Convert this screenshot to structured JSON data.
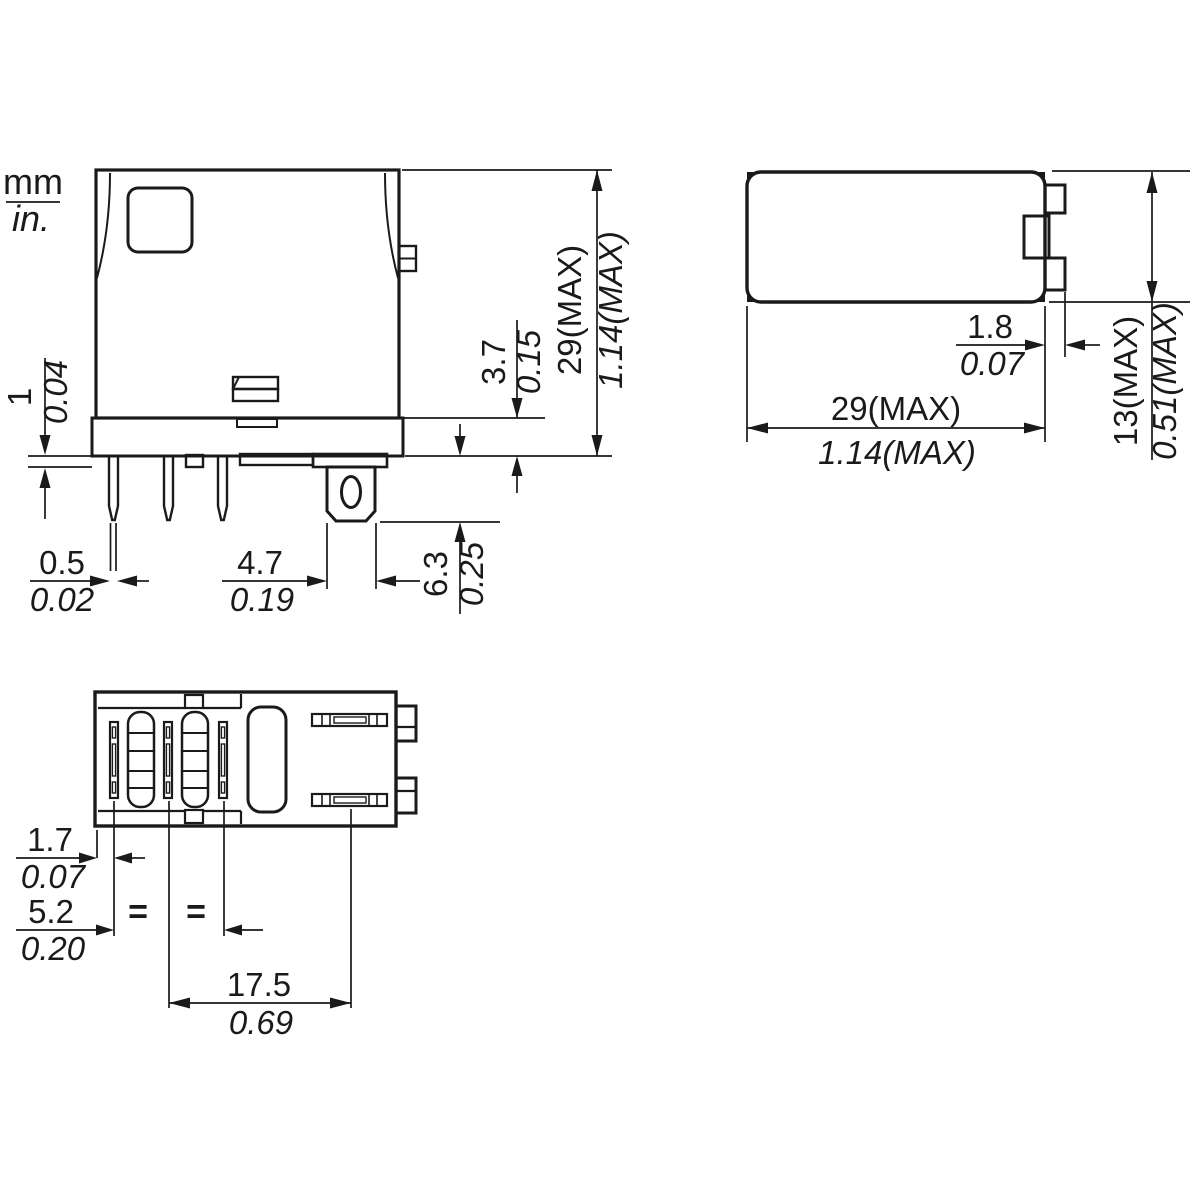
{
  "legend": {
    "mm": "mm",
    "in": "in."
  },
  "colors": {
    "body_fill": "#dcdcdc",
    "line": "#1a1a1a",
    "hole_fill": "#ffffff"
  },
  "views": {
    "front": {
      "dims": {
        "standoff": {
          "mm": "1",
          "in": "0.04"
        },
        "base_height": {
          "mm": "3.7",
          "in": "0.15"
        },
        "height": {
          "mm": "29(MAX)",
          "in": "1.14(MAX)"
        },
        "pin_width": {
          "mm": "0.5",
          "in": "0.02"
        },
        "tab_width": {
          "mm": "4.7",
          "in": "0.19"
        },
        "tab_length": {
          "mm": "6.3",
          "in": "0.25"
        }
      }
    },
    "top": {
      "dims": {
        "tab_protrusion": {
          "mm": "1.8",
          "in": "0.07"
        },
        "width": {
          "mm": "29(MAX)",
          "in": "1.14(MAX)"
        },
        "depth": {
          "mm": "13(MAX)",
          "in": "0.51(MAX)"
        }
      }
    },
    "bottom": {
      "dims": {
        "edge_to_pin": {
          "mm": "1.7",
          "in": "0.07"
        },
        "pin_pitch": {
          "mm": "5.2",
          "in": "0.20"
        },
        "pin_to_tab": {
          "mm": "17.5",
          "in": "0.69"
        }
      },
      "equal_marks": [
        "=",
        "="
      ]
    }
  }
}
